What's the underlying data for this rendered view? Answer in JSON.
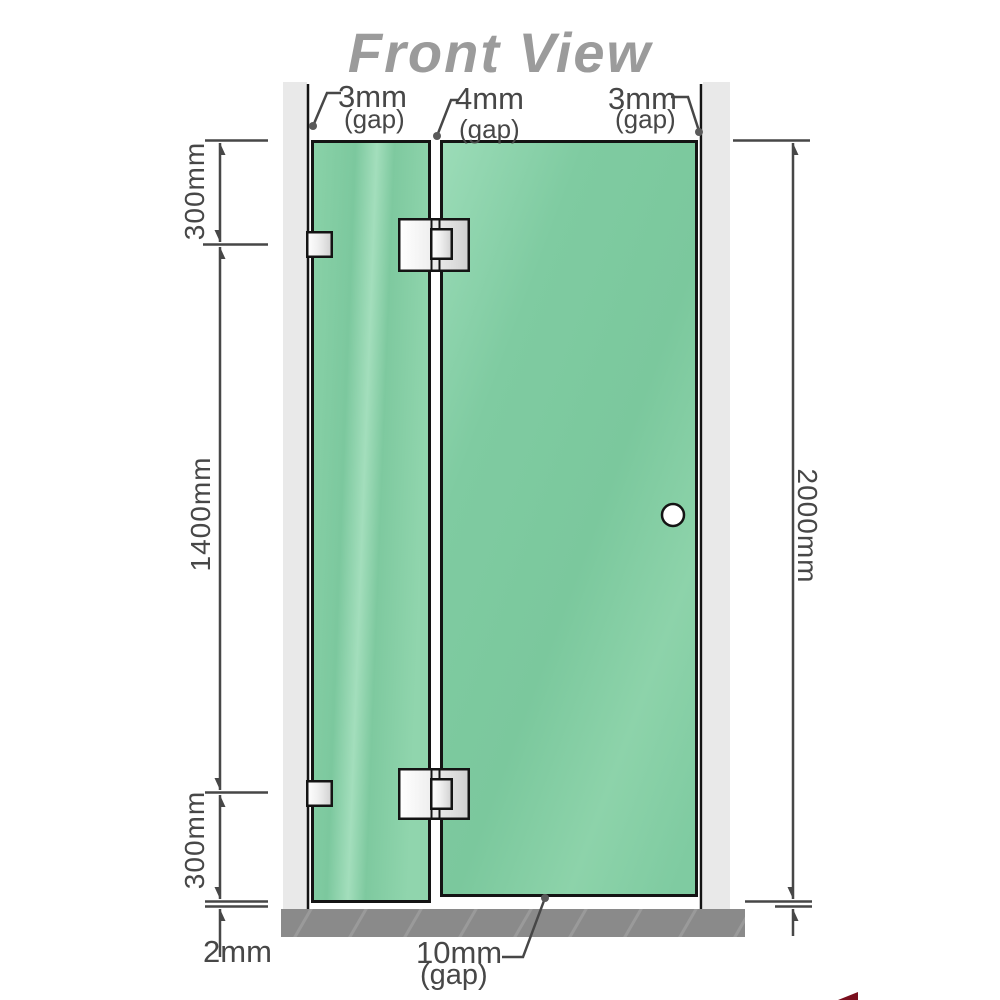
{
  "title": "Front View",
  "annotations": {
    "gap_left": {
      "value": "3mm",
      "label": "(gap)"
    },
    "gap_middle": {
      "value": "4mm",
      "label": "(gap)"
    },
    "gap_right": {
      "value": "3mm",
      "label": "(gap)"
    },
    "height_top_segment": "300mm",
    "height_middle_segment": "1400mm",
    "height_bottom_segment": "300mm",
    "floor_clearance": "2mm",
    "total_height": "2000mm",
    "door_bottom_gap": {
      "value": "10mm",
      "label": "(gap)"
    }
  },
  "colors": {
    "glass_green": "#7cc89e",
    "glass_highlight": "#a5dfbe",
    "wall_gray": "#e9e9e9",
    "floor_gray": "#8a8a8a",
    "outline_black": "#141414",
    "title_gray": "#9b9b9b",
    "dimension_gray": "#474747",
    "logo_red": "#7a0f1e"
  }
}
